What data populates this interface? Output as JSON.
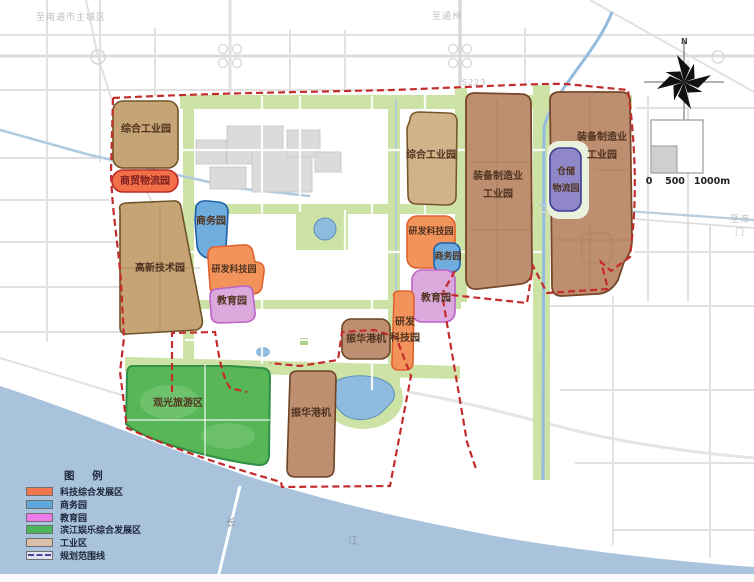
{
  "edge_labels": {
    "to_nantong": "至南通市主城区",
    "to_tongzhou": "至通州",
    "road_s223": "S223",
    "to_haimen": "至海门",
    "river_char_1": "长",
    "river_char_2": "江"
  },
  "zones": [
    {
      "id": "comprehensive-industrial-nw",
      "label": "综合工业园"
    },
    {
      "id": "trade-logistics-park",
      "label": "商贸物流园"
    },
    {
      "id": "hightech-park",
      "label": "高新技术园"
    },
    {
      "id": "business-park-west",
      "label": "商务园"
    },
    {
      "id": "rd-science-park-west",
      "label": "研发科技园"
    },
    {
      "id": "education-park-west",
      "label": "教育园"
    },
    {
      "id": "comprehensive-industrial-mid",
      "label": "综合工业园"
    },
    {
      "id": "rd-science-park-mid",
      "label": "研发科技园"
    },
    {
      "id": "business-park-east",
      "label": "商务园"
    },
    {
      "id": "education-park-east",
      "label": "教育园"
    },
    {
      "id": "rd-science-park-south",
      "label": "研发\n科技园"
    },
    {
      "id": "zhenhua-port-north",
      "label": "振华港机"
    },
    {
      "id": "zhenhua-port-south",
      "label": "振华港机"
    },
    {
      "id": "sightseeing-tourism-area",
      "label": "观光旅游区"
    },
    {
      "id": "equipment-manufacturing-west",
      "label": "装备制造业\n工业园"
    },
    {
      "id": "warehouse-logistics-park",
      "label": "仓储\n物流园"
    },
    {
      "id": "equipment-manufacturing-east",
      "label": "装备制造业\n工业园"
    }
  ],
  "zone_colors": {
    "industrial": "#C7A476",
    "industrial_light": "#D2B289",
    "industrial_dark": "#BE8E71",
    "tech": "#F2935B",
    "tech_bright": "#F26F49",
    "business": "#6FADDF",
    "education": "#DCA9DD",
    "warehouse": "#9087C8",
    "recreation": "#57B757"
  },
  "colors": {
    "boundary": "#C32C2C",
    "river": "#A9C3DC",
    "road": "#DCDCDC",
    "green_corridor": "#CDE3A5",
    "canal": "#93BCDF",
    "built_block": "#DBDBDB"
  },
  "compass": {
    "north_label": "N"
  },
  "scale_bar": {
    "tick_labels": [
      "0",
      "500",
      "1000m"
    ]
  },
  "legend": {
    "title": "图 例",
    "items": [
      {
        "label": "科技综合发展区",
        "color": "#F4764E"
      },
      {
        "label": "商务园",
        "color": "#5FA8DC"
      },
      {
        "label": "教育园",
        "color": "#EE7BEB"
      },
      {
        "label": "滨江娱乐综合发展区",
        "color": "#4CB75A"
      },
      {
        "label": "工业区",
        "color": "#D9C0A6"
      },
      {
        "label": "规划范围线",
        "color": "#52418F"
      }
    ]
  }
}
